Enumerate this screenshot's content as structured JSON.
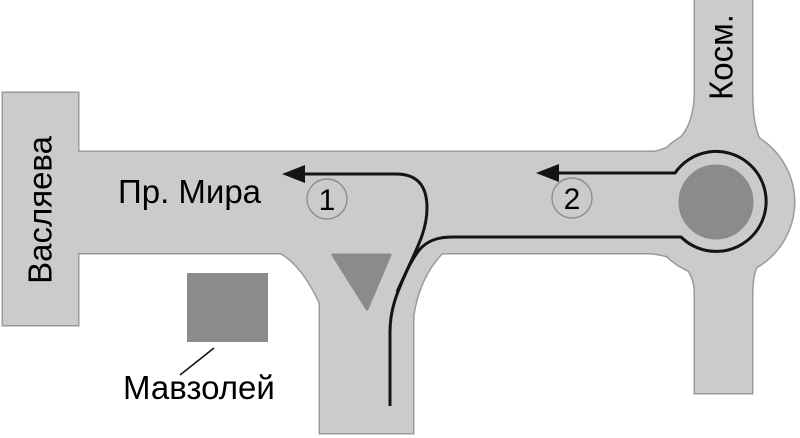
{
  "labels": {
    "left_road": "Васляева",
    "main_road": "Пр. Мира",
    "top_road": "Косм.",
    "landmark": "Мавзолей"
  },
  "route_markers": [
    {
      "label": "1"
    },
    {
      "label": "2"
    }
  ],
  "colors": {
    "background": "#ffffff",
    "road_fill": "#cbcbcb",
    "road_border": "#9a9a9a",
    "island_fill": "#8b8b8b",
    "route_line": "#141414",
    "badge_border": "#8e8e8e",
    "text": "#000000"
  }
}
